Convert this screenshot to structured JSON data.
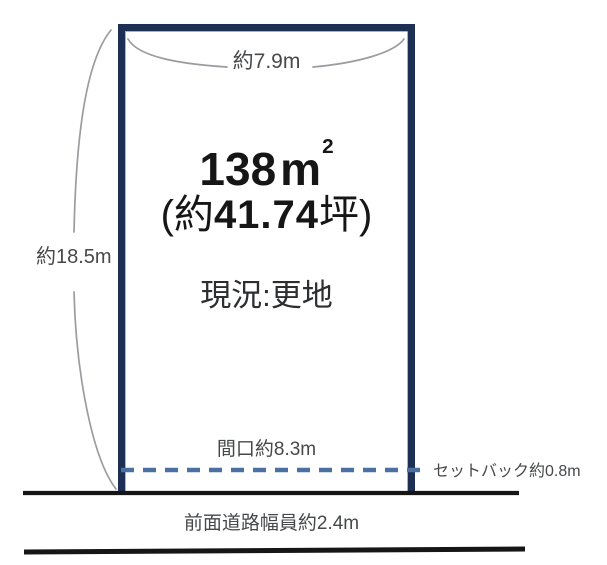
{
  "diagram": {
    "labels": {
      "top_width": "約7.9m",
      "side_height": "約18.5m",
      "frontage": "間口約8.3m",
      "setback": "セットバック約0.8m",
      "road_width": "前面道路幅員約2.4m",
      "status": "現況:更地"
    },
    "area": {
      "number": "138",
      "unit": "m",
      "exponent": "2",
      "tsubo_prefix": "(約",
      "tsubo_number": "41.74",
      "tsubo_suffix": "坪)"
    },
    "colors": {
      "plot_border": "#1d3054",
      "setback_dash": "#4c70a4",
      "road_line": "#161616",
      "dimension_curve": "#9a9ca0",
      "text": "#46484a"
    }
  }
}
